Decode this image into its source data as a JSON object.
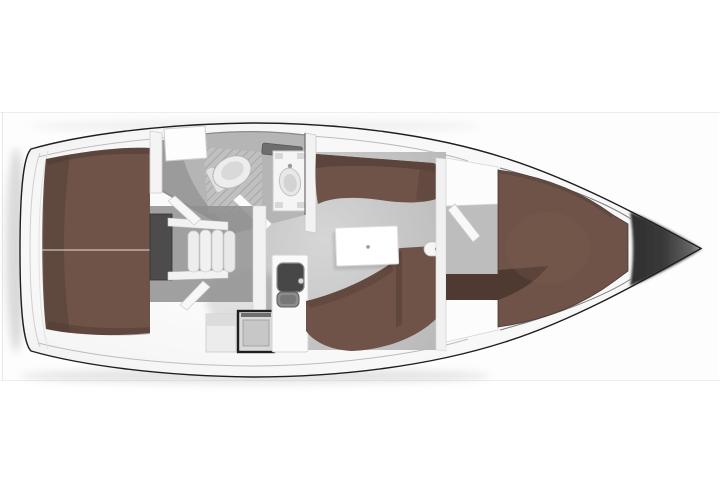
{
  "diagram": {
    "type": "sailboat-interior-floorplan-top-view",
    "orientation": "bow-right",
    "parts": [
      "stern-transom",
      "aft-cabin-berth",
      "engine-compartment",
      "companionway-steps",
      "wet-head",
      "shower-grate",
      "toilet",
      "washbasin",
      "head-door",
      "galley",
      "stove",
      "galley-sink",
      "saloon-floor",
      "saloon-table",
      "port-settee",
      "starboard-settee",
      "water-heater",
      "forward-bulkhead",
      "forward-cabin-door",
      "v-berth",
      "bow-tip"
    ]
  },
  "colors": {
    "background": "#ffffff",
    "frame_line": "#ededed",
    "hull_outline": "#1f1f1f",
    "deck_white": "#f9f9f9",
    "floor": "#c8c8c8",
    "head_floor": "#b5b5b5",
    "berth": "#6f5348",
    "berth_dark": "#57423a",
    "engine_box": "#4c4c4c",
    "fixture_white": "#f3f3f3",
    "stove_frame": "#1e1e1e",
    "sink_dark": "#474747",
    "wall_line": "#8a8a8a",
    "bow_dark": "#2e2e2e"
  }
}
